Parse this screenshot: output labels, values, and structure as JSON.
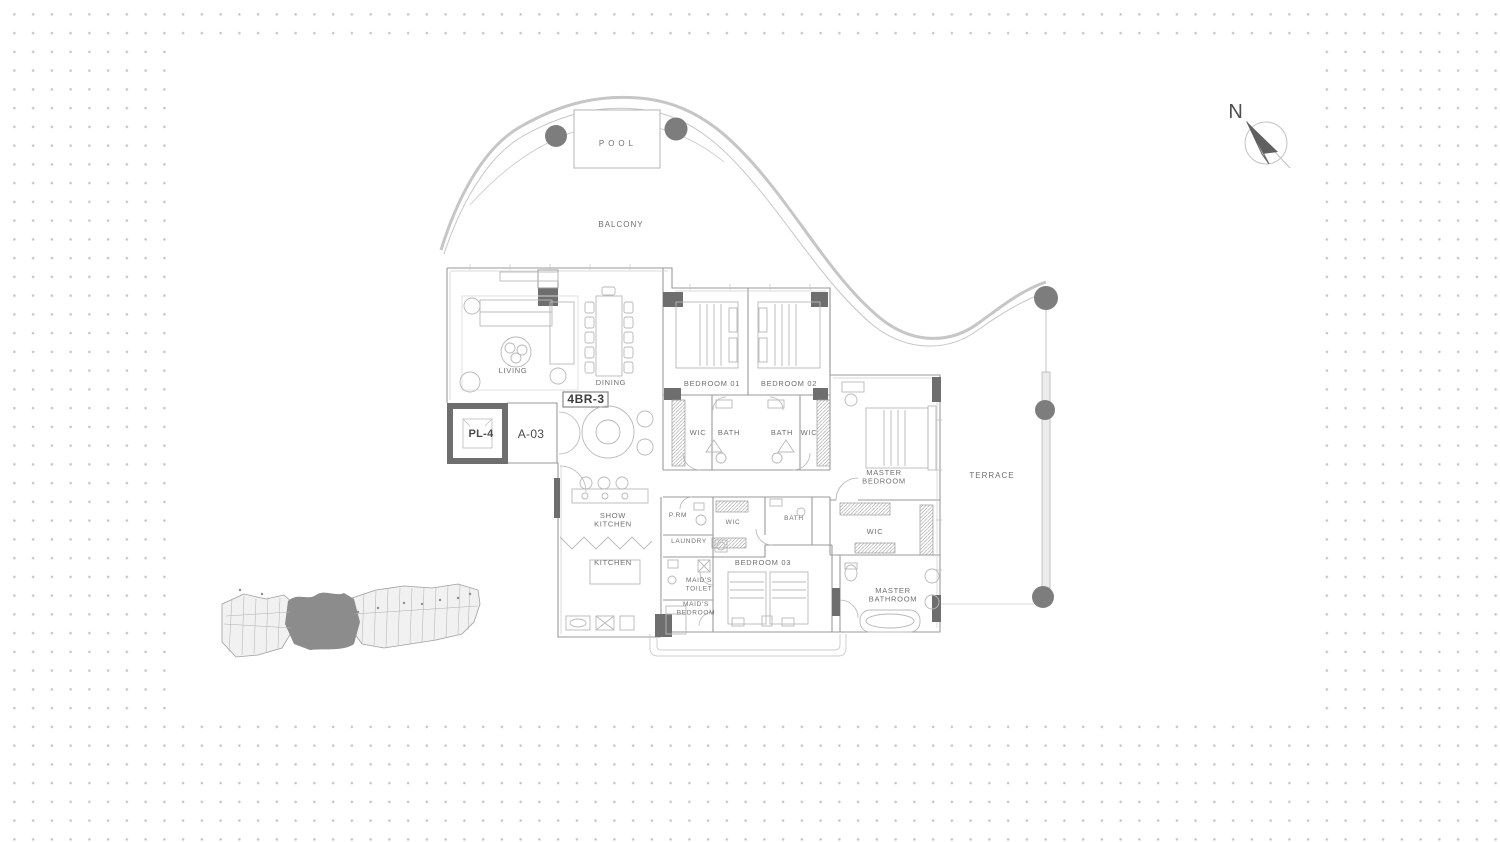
{
  "colors": {
    "dot": "#c5c5c5",
    "wall": "#9a9a9a",
    "wall_dark": "#6e6e6e",
    "column": "#7d7d7d",
    "furniture": "#b8b8b8",
    "balcony": "#c6c6c6",
    "label": "#6f6f6f",
    "keyplan_fill": "#f1f1f1",
    "keyplan_highlight": "#8c8c8c"
  },
  "unit": {
    "type_code": "4BR-3",
    "lift_code": "PL-4",
    "unit_number": "A-03"
  },
  "compass": {
    "north": "N"
  },
  "floor_plan": {
    "labels": [
      {
        "id": "pool",
        "text": "POOL",
        "x": 618,
        "y": 146,
        "size": 8,
        "ls": 4
      },
      {
        "id": "balcony",
        "text": "BALCONY",
        "x": 621,
        "y": 227,
        "size": 8,
        "ls": 1
      },
      {
        "id": "living",
        "text": "LIVING",
        "x": 513,
        "y": 373
      },
      {
        "id": "dining",
        "text": "DINING",
        "x": 611,
        "y": 385
      },
      {
        "id": "unit-type",
        "text": "4BR-3",
        "x": 586,
        "y": 403,
        "size": 12,
        "bold": true,
        "color": "#3d3d3d",
        "ls": 0.5
      },
      {
        "id": "lift",
        "text": "PL-4",
        "x": 481,
        "y": 437,
        "size": 11,
        "bold": true,
        "color": "#4a4a4a",
        "ls": 0.3
      },
      {
        "id": "unit-number",
        "text": "A-03",
        "x": 531,
        "y": 438,
        "size": 12,
        "color": "#4a4a4a",
        "ls": 0.3
      },
      {
        "id": "bedroom-01",
        "text": "BEDROOM 01",
        "x": 712,
        "y": 386
      },
      {
        "id": "bedroom-02",
        "text": "BEDROOM 02",
        "x": 789,
        "y": 386
      },
      {
        "id": "wic-bedroom-01",
        "text": "WIC",
        "x": 698,
        "y": 435
      },
      {
        "id": "bath-bedroom-01",
        "text": "BATH",
        "x": 729,
        "y": 435
      },
      {
        "id": "bath-bedroom-02",
        "text": "BATH",
        "x": 782,
        "y": 435
      },
      {
        "id": "wic-bedroom-02",
        "text": "WIC",
        "x": 809,
        "y": 435
      },
      {
        "id": "master-bedroom",
        "text": "MASTER\nBEDROOM",
        "x": 884,
        "y": 475
      },
      {
        "id": "terrace",
        "text": "TERRACE",
        "x": 992,
        "y": 478,
        "size": 8,
        "ls": 1
      },
      {
        "id": "show-kitchen",
        "text": "SHOW\nKITCHEN",
        "x": 613,
        "y": 518
      },
      {
        "id": "powder-room",
        "text": "P.RM",
        "x": 678,
        "y": 517,
        "size": 6.5
      },
      {
        "id": "wic-corridor",
        "text": "WIC",
        "x": 733,
        "y": 524,
        "size": 6.5
      },
      {
        "id": "bath-bedroom-03",
        "text": "BATH",
        "x": 794,
        "y": 520,
        "size": 6.5
      },
      {
        "id": "laundry",
        "text": "LAUNDRY",
        "x": 689,
        "y": 543,
        "size": 6.5
      },
      {
        "id": "wic-master",
        "text": "WIC",
        "x": 875,
        "y": 534
      },
      {
        "id": "bedroom-03",
        "text": "BEDROOM 03",
        "x": 763,
        "y": 565
      },
      {
        "id": "kitchen",
        "text": "KITCHEN",
        "x": 613,
        "y": 565
      },
      {
        "id": "maids-toilet",
        "text": "MAID'S\nTOILET",
        "x": 699,
        "y": 582,
        "size": 6.5
      },
      {
        "id": "maids-bedroom",
        "text": "MAID'S\nBEDROOM",
        "x": 696,
        "y": 606,
        "size": 6.5
      },
      {
        "id": "master-bathroom",
        "text": "MASTER\nBATHROOM",
        "x": 893,
        "y": 593
      },
      {
        "id": "north",
        "text": "N",
        "x": 1236,
        "y": 118,
        "size": 20,
        "color": "#4f4f4f"
      }
    ]
  }
}
